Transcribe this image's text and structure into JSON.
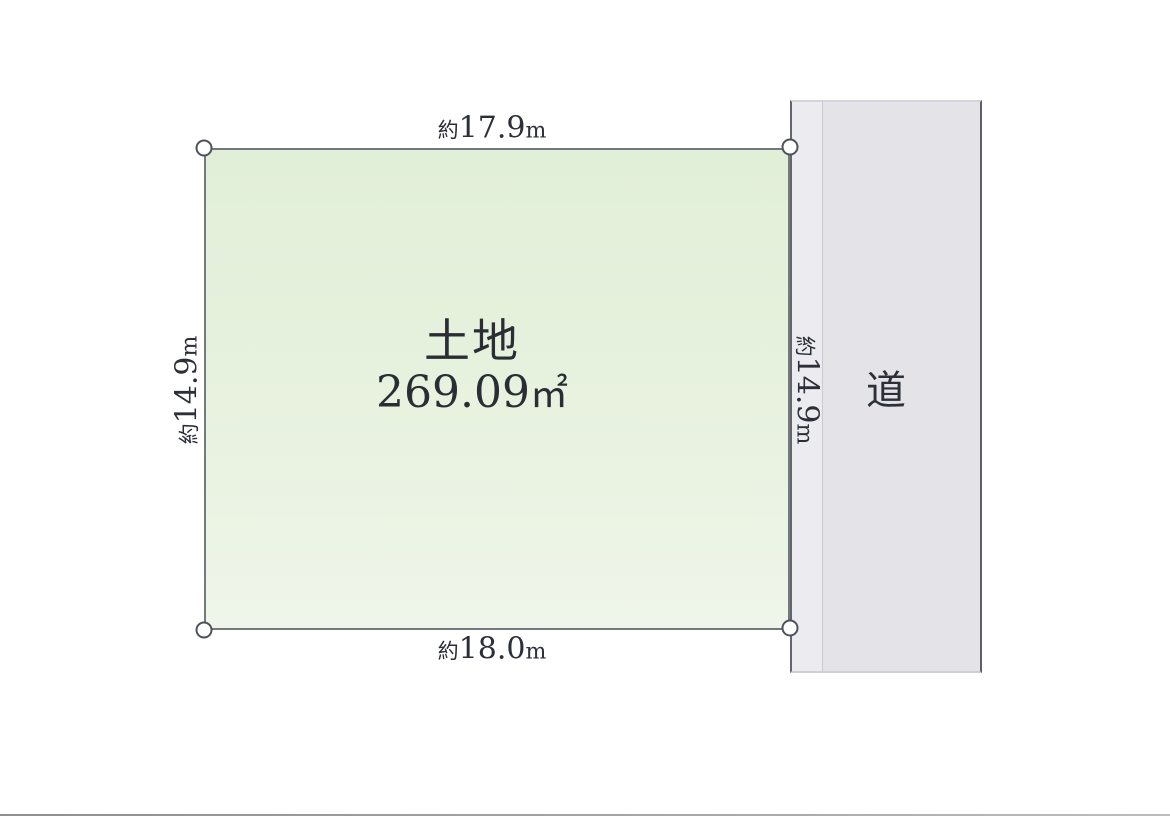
{
  "diagram": {
    "type": "land-plot",
    "plot": {
      "title": "土地",
      "area_value": "269.09",
      "area_unit": "㎡",
      "fill_color": "#e8f2df",
      "border_color": "#75797e"
    },
    "road": {
      "label": "道",
      "fill_color": "#e3e3e8",
      "border_color": "#5d6066"
    },
    "dimensions": {
      "top": {
        "prefix": "約",
        "value": "17.9",
        "unit": "m"
      },
      "bottom": {
        "prefix": "約",
        "value": "18.0",
        "unit": "m"
      },
      "left": {
        "prefix": "約",
        "value": "14.9",
        "unit": "m"
      },
      "right": {
        "prefix": "約",
        "value": "14.9",
        "unit": "m"
      }
    },
    "text_color": "#2c2f38"
  }
}
